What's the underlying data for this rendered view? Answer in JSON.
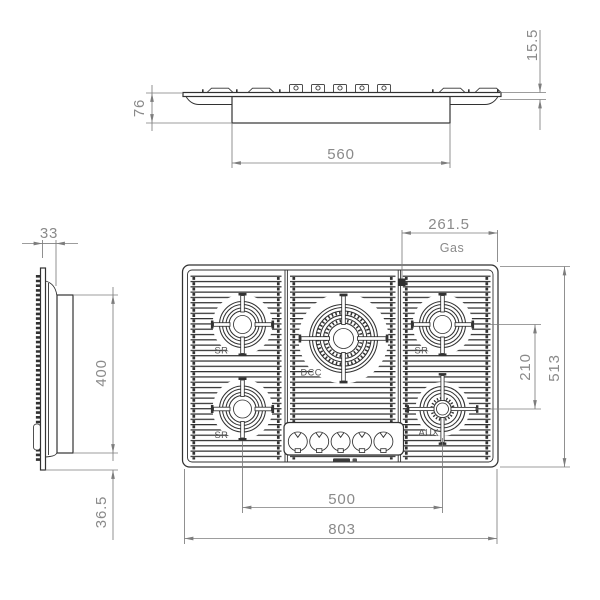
{
  "drawing_type": "gas-hob-installation-dimensions",
  "front_view": {
    "dim_top_height": "15.5",
    "dim_body_height": "76",
    "dim_cutout_width": "560"
  },
  "side_view": {
    "dim_profile_depth": "33",
    "dim_cutout_depth": "400",
    "dim_bottom_offset": "36.5"
  },
  "plan_view": {
    "dim_gas_position": "261.5",
    "gas_label": "Gas",
    "dim_right_burner_spacing": "210",
    "dim_overall_depth": "513",
    "dim_bottom_burner_spacing": "500",
    "dim_overall_width": "803",
    "burners": {
      "top_left": "SR",
      "bottom_left": "SR",
      "top_right": "SR",
      "center": "DCC",
      "bottom_right": "AUX"
    },
    "knob_count": 5
  },
  "colors": {
    "outline": "#323232",
    "dimension_line": "#7d7d7d",
    "dimension_text": "#8a8a8a",
    "background": "#ffffff"
  }
}
